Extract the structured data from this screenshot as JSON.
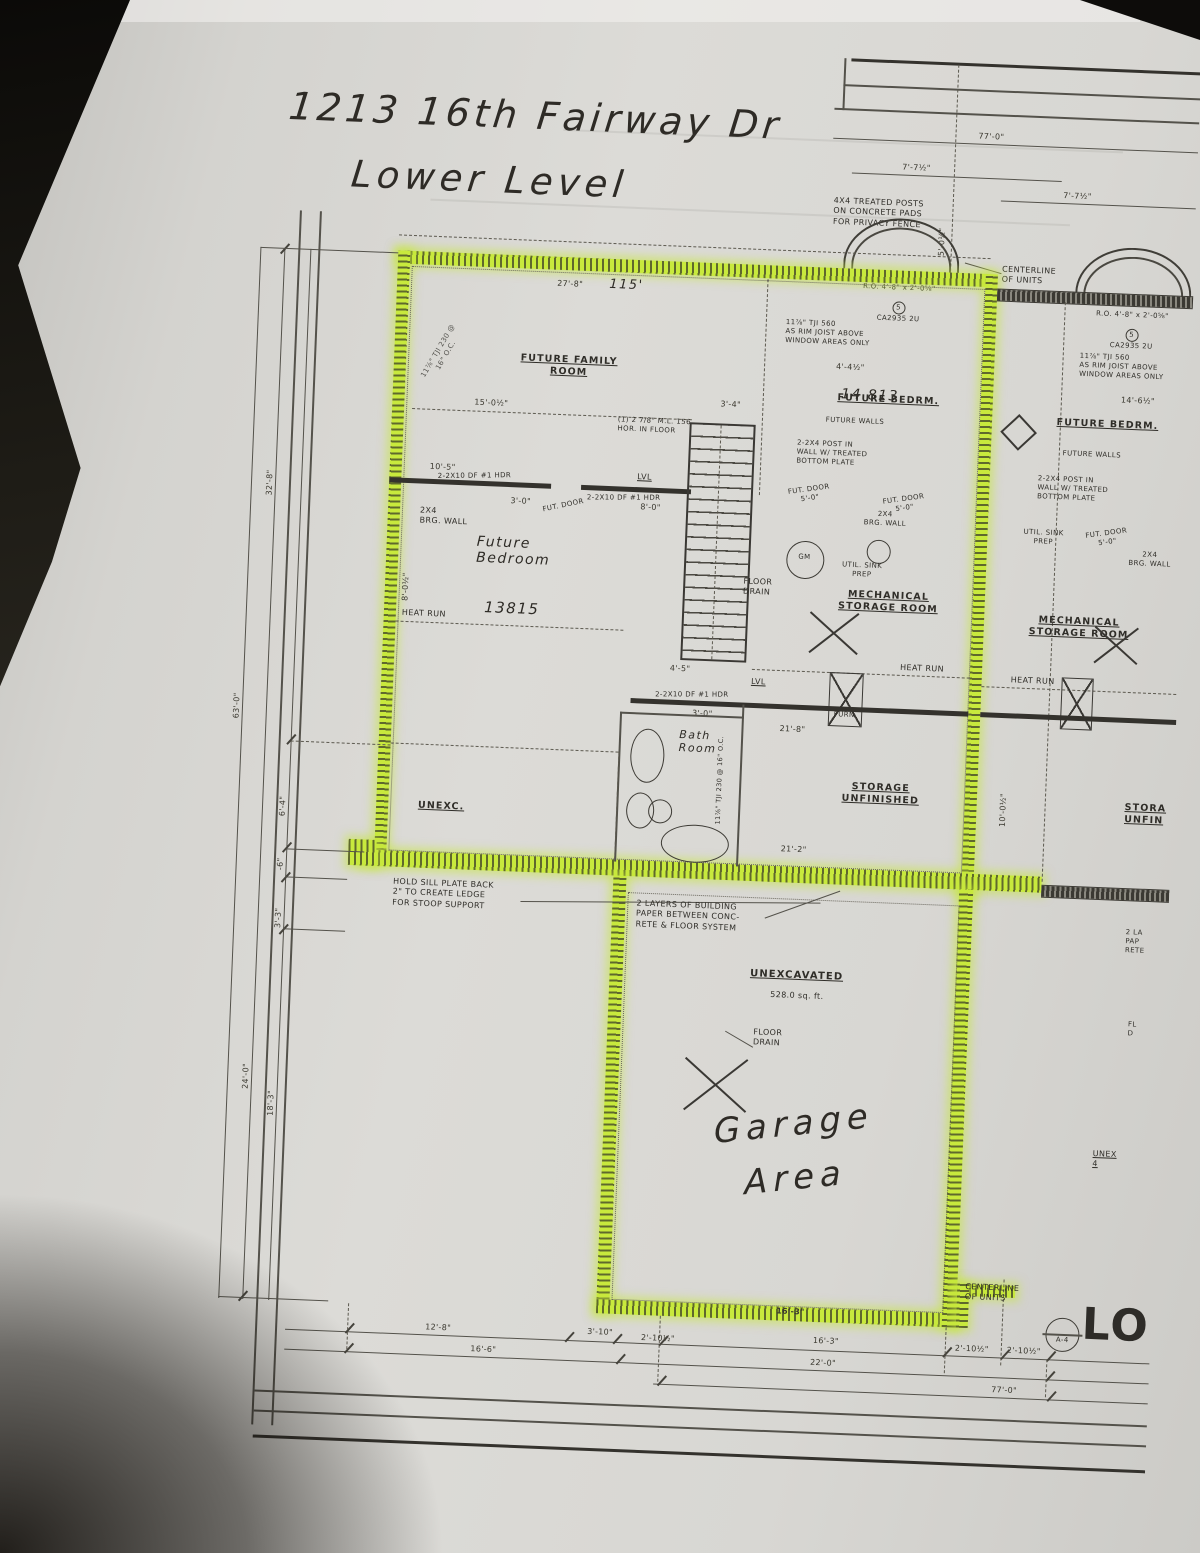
{
  "colors": {
    "highlight": "#c8e93d",
    "ink": "#2f2d28",
    "paper": "#d6d5d1"
  },
  "title": {
    "address": "1213 16th Fairway Dr",
    "level": "Lower Level"
  },
  "rooms": {
    "family": "FUTURE FAMILY\nROOM",
    "bedrm": "FUTURE BEDRM.",
    "mech": "MECHANICAL\nSTORAGE ROOM",
    "storage": "STORAGE\nUNFINISHED",
    "storage_cut": "STORA\nUNFIN",
    "unexc": "UNEXC.",
    "unexcavated": "UNEXCAVATED",
    "unexcavated_area": "528.0 sq. ft.",
    "garage_hw": "Garage\nArea",
    "bath_hw": "Bath\nRoom",
    "future_bedroom_hw": "Future\nBedroom"
  },
  "hw": {
    "n13815": "13815",
    "n14813": "14 813",
    "n115": "115'"
  },
  "notes": {
    "posts": "4X4 TREATED POSTS\nON CONCRETE PADS\nFOR PRIVACY FENCE",
    "centerline": "CENTERLINE\nOF UNITS",
    "rim_joist": "11⅞\" TJI 560\nAS RIM JOIST ABOVE\nWINDOW AREAS ONLY",
    "window_ro": "R.O. 4'-8\" x 2'-0⅝\"",
    "window_tag": "CA2935 2U",
    "window_num": "5",
    "hold_sill": "HOLD SILL PLATE BACK\n2\" TO CREATE LEDGE\nFOR STOOP SUPPORT",
    "bldg_paper": "2 LAYERS OF BUILDING\nPAPER BETWEEN CONC-\nRETE & FLOOR SYSTEM",
    "bldg_paper_cut": "2 LA\nPAP\nRETE",
    "floor_drain": "FLOOR\nDRAIN",
    "floor_drain_cut": "FL\nD",
    "heat_run": "HEAT RUN",
    "lvl": "LVL",
    "fut_door": "FUT. DOOR\n5'-0\"",
    "fut_door_s": "FUT. DOOR",
    "brg_wall": "2X4\nBRG. WALL",
    "future_walls": "FUTURE WALLS",
    "post_wall": "2-2X4 POST IN\nWALL W/ TREATED\nBOTTOM PLATE",
    "util_sink": "UTIL. SINK\nPREP",
    "gm": "GM",
    "furn": "FURN",
    "ml_hdr": "(1) 2 7/8\" M.L. 156\nHOR. IN FLOOR",
    "hdr": "2-2X10 DF #1 HDR",
    "joist": "11⅞\" TJI 230 @ 16\" O.C.",
    "unex_cut": "UNEX\n4",
    "lo": "LO",
    "a4": "A-4"
  },
  "dims": {
    "d77": "77'-0\"",
    "d7_7": "7'-7½\"",
    "d5_0": "5'-0½\"",
    "d4_4": "4'-4½\"",
    "d14_6": "14'-6½\"",
    "d27_8": "27'-8\"",
    "d15_0": "15'-0½\"",
    "d10_5": "10'-5\"",
    "d8_0": "8'-0\"",
    "d3_4": "3'-4\"",
    "d3_0": "3'-0\"",
    "d4_5": "4'-5\"",
    "d8_0h": "8'-0½\"",
    "d10_0": "10'-0½\"",
    "d21_8": "21'-8\"",
    "d21_2": "21'-2\"",
    "d32_8": "32'-8\"",
    "d63_0": "63'-0\"",
    "d6_4": "6'-4\"",
    "dm6": "-6\"",
    "d3_3": "3'-3\"",
    "d24_0": "24'-0\"",
    "d18_3": "18'-3\"",
    "d12_8": "12'-8\"",
    "d3_10": "3'-10\"",
    "d2_10": "2'-10½\"",
    "d16_6": "16'-6\"",
    "d16_3": "16'-3\"",
    "d22_0": "22'-0\""
  }
}
